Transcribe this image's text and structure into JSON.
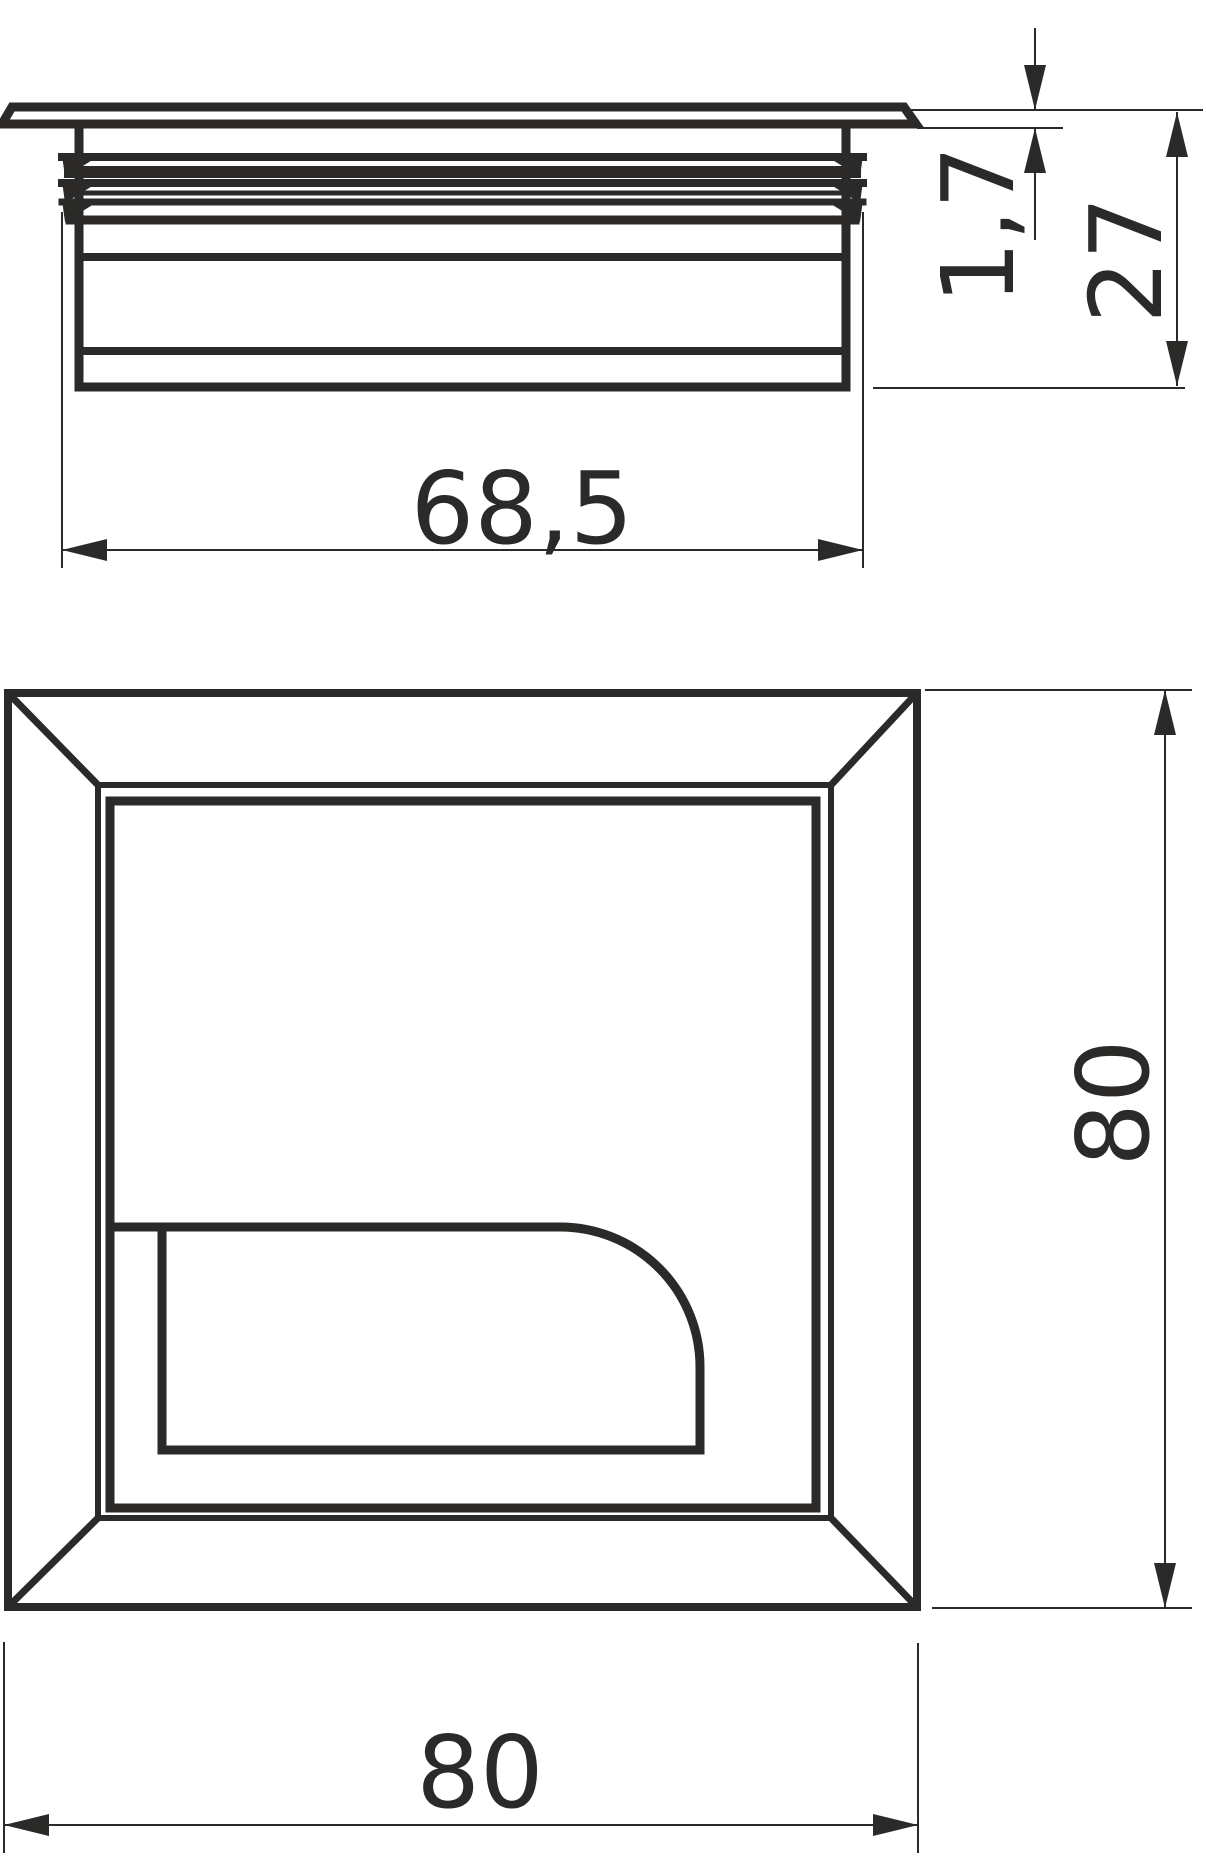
{
  "style": {
    "line_color": "#2b2a29",
    "background_color": "#ffffff"
  },
  "side_view": {
    "width_label": "68,5",
    "flange_label": "1,7",
    "height_label": "27"
  },
  "plan_view": {
    "width_label": "80",
    "height_label": "80"
  }
}
